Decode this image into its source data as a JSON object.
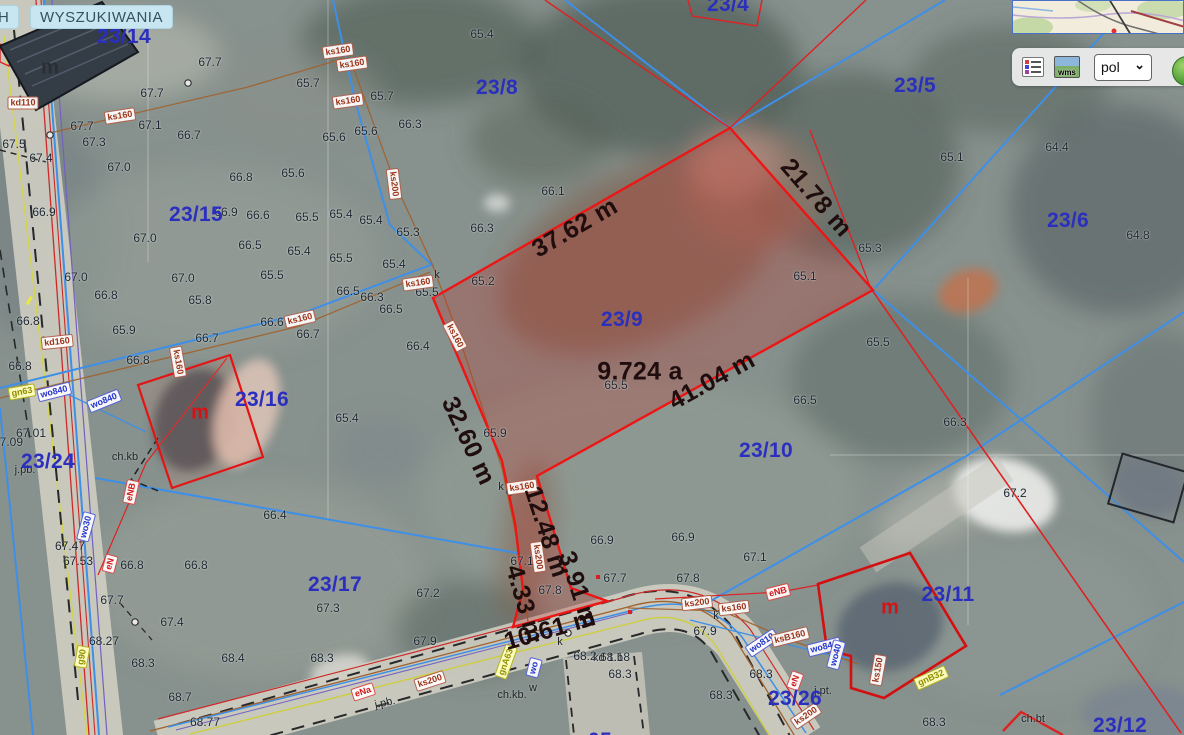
{
  "app": {
    "tabs": [
      {
        "label": "H"
      },
      {
        "label": "WYSZUKIWANIA"
      }
    ]
  },
  "toolbar": {
    "language_value": "pol",
    "wms_text": "wms"
  },
  "selection": {
    "parcel_id": "23/9",
    "area_label": "9.724 a",
    "outline_color": "#ee1515",
    "measurements": [
      "37.62 m",
      "21.78 m",
      "41.04 m",
      "32.60 m",
      "12.48 m",
      "3.91 m",
      "4.33 m",
      "10.61 m"
    ]
  },
  "colors": {
    "parcel_text": "#2b2fbe",
    "measurement_text": "#200d0d",
    "boundary_blue": "#3d8fe8",
    "boundary_red": "#dd2222",
    "sewer_brown": "#a0622d"
  },
  "map": {
    "parcel_labels": [
      {
        "t": "23/14",
        "x": 124,
        "y": 37
      },
      {
        "t": "23/4",
        "x": 728,
        "y": 5
      },
      {
        "t": "23/8",
        "x": 497,
        "y": 88
      },
      {
        "t": "23/5",
        "x": 915,
        "y": 86
      },
      {
        "t": "23/6",
        "x": 1068,
        "y": 221
      },
      {
        "t": "23/15",
        "x": 196,
        "y": 215
      },
      {
        "t": "23/9",
        "x": 622,
        "y": 320
      },
      {
        "t": "23/16",
        "x": 262,
        "y": 400
      },
      {
        "t": "23/10",
        "x": 766,
        "y": 451
      },
      {
        "t": "23/24",
        "x": 48,
        "y": 462
      },
      {
        "t": "23/17",
        "x": 335,
        "y": 585
      },
      {
        "t": "23/11",
        "x": 948,
        "y": 595
      },
      {
        "t": "23/26",
        "x": 795,
        "y": 699
      },
      {
        "t": "23/12",
        "x": 1120,
        "y": 726
      },
      {
        "t": "05",
        "x": 600,
        "y": 741
      }
    ],
    "measurement_labels": [
      {
        "t": "37.62 m",
        "x": 575,
        "y": 228,
        "r": -30
      },
      {
        "t": "21.78 m",
        "x": 816,
        "y": 198,
        "r": 49
      },
      {
        "t": "41.04 m",
        "x": 712,
        "y": 381,
        "r": -29
      },
      {
        "t": "9.724 a",
        "x": 640,
        "y": 372,
        "r": 0
      },
      {
        "t": "32.60 m",
        "x": 468,
        "y": 441,
        "r": 65
      },
      {
        "t": "12.48 m",
        "x": 546,
        "y": 532,
        "r": 72
      },
      {
        "t": "3.91 m",
        "x": 578,
        "y": 590,
        "r": 72
      },
      {
        "t": "4.33 m",
        "x": 524,
        "y": 604,
        "r": 74
      },
      {
        "t": "10.61 m",
        "x": 550,
        "y": 630,
        "r": -16
      }
    ],
    "utility_labels": [
      {
        "t": "kd110",
        "x": 23,
        "y": 103,
        "r": 0,
        "k": "ks"
      },
      {
        "t": "ks160",
        "x": 120,
        "y": 116,
        "r": -9,
        "k": "ks"
      },
      {
        "t": "ks160",
        "x": 338,
        "y": 51,
        "r": -8,
        "k": "ks"
      },
      {
        "t": "ks160",
        "x": 352,
        "y": 64,
        "r": -8,
        "k": "ks"
      },
      {
        "t": "ks160",
        "x": 348,
        "y": 101,
        "r": -8,
        "k": "ks"
      },
      {
        "t": "ks200",
        "x": 394,
        "y": 184,
        "r": 83,
        "k": "ks"
      },
      {
        "t": "ks160",
        "x": 300,
        "y": 319,
        "r": -13,
        "k": "ks"
      },
      {
        "t": "ks160",
        "x": 418,
        "y": 283,
        "r": -8,
        "k": "ks"
      },
      {
        "t": "ks160",
        "x": 455,
        "y": 336,
        "r": 62,
        "k": "ks"
      },
      {
        "t": "ks160",
        "x": 178,
        "y": 362,
        "r": 80,
        "k": "ks"
      },
      {
        "t": "kd160",
        "x": 57,
        "y": 342,
        "r": -6,
        "k": "ks"
      },
      {
        "t": "wo840",
        "x": 54,
        "y": 392,
        "r": -14,
        "k": "wo"
      },
      {
        "t": "wo840",
        "x": 104,
        "y": 401,
        "r": -22,
        "k": "wo"
      },
      {
        "t": "gn63",
        "x": 22,
        "y": 392,
        "r": -10,
        "k": "gn"
      },
      {
        "t": "eNB",
        "x": 131,
        "y": 492,
        "r": -78,
        "k": "e"
      },
      {
        "t": "wo30",
        "x": 86,
        "y": 527,
        "r": -75,
        "k": "wo"
      },
      {
        "t": "eN",
        "x": 110,
        "y": 564,
        "r": -75,
        "k": "e"
      },
      {
        "t": "g90",
        "x": 82,
        "y": 657,
        "r": -80,
        "k": "gn"
      },
      {
        "t": "eNa",
        "x": 363,
        "y": 692,
        "r": -18,
        "k": "e"
      },
      {
        "t": "ks200",
        "x": 430,
        "y": 681,
        "r": -18,
        "k": "ks"
      },
      {
        "t": "gnA63",
        "x": 506,
        "y": 662,
        "r": -70,
        "k": "gn"
      },
      {
        "t": "wo",
        "x": 534,
        "y": 668,
        "r": -75,
        "k": "wo"
      },
      {
        "t": "ks160",
        "x": 522,
        "y": 487,
        "r": -8,
        "k": "ks"
      },
      {
        "t": "ks200",
        "x": 538,
        "y": 557,
        "r": 82,
        "k": "ks"
      },
      {
        "t": "ks200",
        "x": 697,
        "y": 603,
        "r": -7,
        "k": "ks"
      },
      {
        "t": "ks160",
        "x": 734,
        "y": 608,
        "r": -7,
        "k": "ks"
      },
      {
        "t": "eNB",
        "x": 778,
        "y": 592,
        "r": -14,
        "k": "e"
      },
      {
        "t": "wo810",
        "x": 762,
        "y": 643,
        "r": -34,
        "k": "wo"
      },
      {
        "t": "ksB160",
        "x": 790,
        "y": 637,
        "r": -14,
        "k": "ks"
      },
      {
        "t": "wo840",
        "x": 824,
        "y": 647,
        "r": -14,
        "k": "wo"
      },
      {
        "t": "eN",
        "x": 795,
        "y": 681,
        "r": -70,
        "k": "e"
      },
      {
        "t": "ks200",
        "x": 806,
        "y": 716,
        "r": -34,
        "k": "ks"
      },
      {
        "t": "gnB32",
        "x": 931,
        "y": 678,
        "r": -24,
        "k": "gn"
      },
      {
        "t": "wo40",
        "x": 836,
        "y": 655,
        "r": -75,
        "k": "wo"
      },
      {
        "t": "ks150",
        "x": 878,
        "y": 670,
        "r": -80,
        "k": "ks"
      }
    ],
    "elevation_labels": [
      {
        "t": "67.7",
        "x": 210,
        "y": 62
      },
      {
        "t": "67.7",
        "x": 152,
        "y": 93
      },
      {
        "t": "65.4",
        "x": 482,
        "y": 34
      },
      {
        "t": "67.7",
        "x": 82,
        "y": 126
      },
      {
        "t": "67.1",
        "x": 150,
        "y": 125
      },
      {
        "t": "66.7",
        "x": 189,
        "y": 135
      },
      {
        "t": "67.3",
        "x": 94,
        "y": 142
      },
      {
        "t": "67.5",
        "x": 14,
        "y": 144
      },
      {
        "t": "67.4",
        "x": 41,
        "y": 158
      },
      {
        "t": "67.0",
        "x": 119,
        "y": 167
      },
      {
        "t": "66.8",
        "x": 241,
        "y": 177
      },
      {
        "t": "65.7",
        "x": 308,
        "y": 83
      },
      {
        "t": "65.7",
        "x": 382,
        "y": 96
      },
      {
        "t": "66.3",
        "x": 410,
        "y": 124
      },
      {
        "t": "65.6",
        "x": 366,
        "y": 131
      },
      {
        "t": "65.6",
        "x": 334,
        "y": 137
      },
      {
        "t": "66.1",
        "x": 553,
        "y": 191
      },
      {
        "t": "66.3",
        "x": 482,
        "y": 228
      },
      {
        "t": "65.3",
        "x": 408,
        "y": 232
      },
      {
        "t": "65.2",
        "x": 483,
        "y": 281
      },
      {
        "t": "66.9",
        "x": 44,
        "y": 212
      },
      {
        "t": "66.9",
        "x": 226,
        "y": 212
      },
      {
        "t": "67.0",
        "x": 145,
        "y": 238
      },
      {
        "t": "65.6",
        "x": 293,
        "y": 173
      },
      {
        "t": "66.6",
        "x": 258,
        "y": 215
      },
      {
        "t": "65.5",
        "x": 307,
        "y": 217
      },
      {
        "t": "65.4",
        "x": 341,
        "y": 214
      },
      {
        "t": "65.4",
        "x": 371,
        "y": 220
      },
      {
        "t": "66.5",
        "x": 250,
        "y": 245
      },
      {
        "t": "65.4",
        "x": 299,
        "y": 251
      },
      {
        "t": "65.5",
        "x": 341,
        "y": 258
      },
      {
        "t": "65.5",
        "x": 272,
        "y": 275
      },
      {
        "t": "67.0",
        "x": 183,
        "y": 278
      },
      {
        "t": "67.0",
        "x": 76,
        "y": 277
      },
      {
        "t": "66.8",
        "x": 106,
        "y": 295
      },
      {
        "t": "65.8",
        "x": 200,
        "y": 300
      },
      {
        "t": "66.8",
        "x": 28,
        "y": 321
      },
      {
        "t": "66.6",
        "x": 272,
        "y": 322
      },
      {
        "t": "65.9",
        "x": 124,
        "y": 330
      },
      {
        "t": "66.7",
        "x": 308,
        "y": 334
      },
      {
        "t": "66.8",
        "x": 20,
        "y": 366
      },
      {
        "t": "66.5",
        "x": 348,
        "y": 291
      },
      {
        "t": "66.3",
        "x": 372,
        "y": 297
      },
      {
        "t": "66.5",
        "x": 391,
        "y": 309
      },
      {
        "t": "65.4",
        "x": 394,
        "y": 264
      },
      {
        "t": "65.5",
        "x": 427,
        "y": 292
      },
      {
        "t": "66.4",
        "x": 418,
        "y": 346
      },
      {
        "t": "65.4",
        "x": 347,
        "y": 418
      },
      {
        "t": "65.1",
        "x": 805,
        "y": 276
      },
      {
        "t": "65.3",
        "x": 870,
        "y": 248
      },
      {
        "t": "65.1",
        "x": 952,
        "y": 157
      },
      {
        "t": "64.4",
        "x": 1057,
        "y": 147
      },
      {
        "t": "64.8",
        "x": 1138,
        "y": 235
      },
      {
        "t": "65.5",
        "x": 878,
        "y": 342
      },
      {
        "t": "66.3",
        "x": 955,
        "y": 422
      },
      {
        "t": "67.2",
        "x": 1015,
        "y": 493
      },
      {
        "t": "66.5",
        "x": 805,
        "y": 400
      },
      {
        "t": "65.5",
        "x": 616,
        "y": 385
      },
      {
        "t": "65.9",
        "x": 495,
        "y": 433
      },
      {
        "t": "66.7",
        "x": 207,
        "y": 338
      },
      {
        "t": "66.8",
        "x": 138,
        "y": 360
      },
      {
        "t": "66.4",
        "x": 275,
        "y": 515
      },
      {
        "t": "66.9",
        "x": 602,
        "y": 540
      },
      {
        "t": "66.9",
        "x": 683,
        "y": 537
      },
      {
        "t": "67.7",
        "x": 615,
        "y": 578
      },
      {
        "t": "67.8",
        "x": 688,
        "y": 578
      },
      {
        "t": "67.8",
        "x": 550,
        "y": 590
      },
      {
        "t": "67.2",
        "x": 428,
        "y": 593
      },
      {
        "t": "67.1",
        "x": 522,
        "y": 561
      },
      {
        "t": "67.9",
        "x": 425,
        "y": 641
      },
      {
        "t": "67.1",
        "x": 755,
        "y": 557
      },
      {
        "t": "67.9",
        "x": 705,
        "y": 631
      },
      {
        "t": "68.2",
        "x": 585,
        "y": 656
      },
      {
        "t": "68.18",
        "x": 615,
        "y": 657
      },
      {
        "t": "68.3",
        "x": 620,
        "y": 674
      },
      {
        "t": "68.3",
        "x": 761,
        "y": 674
      },
      {
        "t": "68.3",
        "x": 721,
        "y": 695
      },
      {
        "t": "68.3",
        "x": 934,
        "y": 722
      },
      {
        "t": "67.01",
        "x": 31,
        "y": 433
      },
      {
        "t": "67.09",
        "x": 8,
        "y": 442
      },
      {
        "t": "67.47",
        "x": 70,
        "y": 546
      },
      {
        "t": "67.53",
        "x": 78,
        "y": 561
      },
      {
        "t": "66.8",
        "x": 132,
        "y": 565
      },
      {
        "t": "66.8",
        "x": 196,
        "y": 565
      },
      {
        "t": "67.7",
        "x": 112,
        "y": 600
      },
      {
        "t": "67.4",
        "x": 172,
        "y": 622
      },
      {
        "t": "68.27",
        "x": 104,
        "y": 641
      },
      {
        "t": "68.3",
        "x": 143,
        "y": 663
      },
      {
        "t": "68.4",
        "x": 233,
        "y": 658
      },
      {
        "t": "68.7",
        "x": 180,
        "y": 697
      },
      {
        "t": "68.77",
        "x": 205,
        "y": 722
      },
      {
        "t": "67.3",
        "x": 328,
        "y": 608
      },
      {
        "t": "68.3",
        "x": 322,
        "y": 658
      }
    ],
    "surface_labels": [
      {
        "t": "ch.kb",
        "x": 125,
        "y": 457,
        "r": 0
      },
      {
        "t": "ch.kb.",
        "x": 512,
        "y": 695,
        "r": 0
      },
      {
        "t": "j.pb.",
        "x": 385,
        "y": 703,
        "r": -12
      },
      {
        "t": "j.pb.",
        "x": 25,
        "y": 470,
        "r": 0
      },
      {
        "t": "j.pt.",
        "x": 823,
        "y": 691,
        "r": 0
      },
      {
        "t": "ch.bt",
        "x": 1033,
        "y": 719,
        "r": 0
      },
      {
        "t": "w",
        "x": 533,
        "y": 688,
        "r": 0
      },
      {
        "t": "k",
        "x": 437,
        "y": 275,
        "r": 0
      },
      {
        "t": "k",
        "x": 501,
        "y": 487,
        "r": 0
      },
      {
        "t": "k",
        "x": 560,
        "y": 642,
        "r": 0
      },
      {
        "t": "k",
        "x": 716,
        "y": 616,
        "r": 0
      },
      {
        "t": "kd 1.b",
        "x": 608,
        "y": 658,
        "r": 0
      }
    ],
    "house_labels": [
      {
        "t": "m",
        "x": 200,
        "y": 413,
        "c": "red"
      },
      {
        "t": "m",
        "x": 890,
        "y": 608,
        "c": "red"
      },
      {
        "t": "m",
        "x": 50,
        "y": 68,
        "c": "dark"
      }
    ]
  }
}
